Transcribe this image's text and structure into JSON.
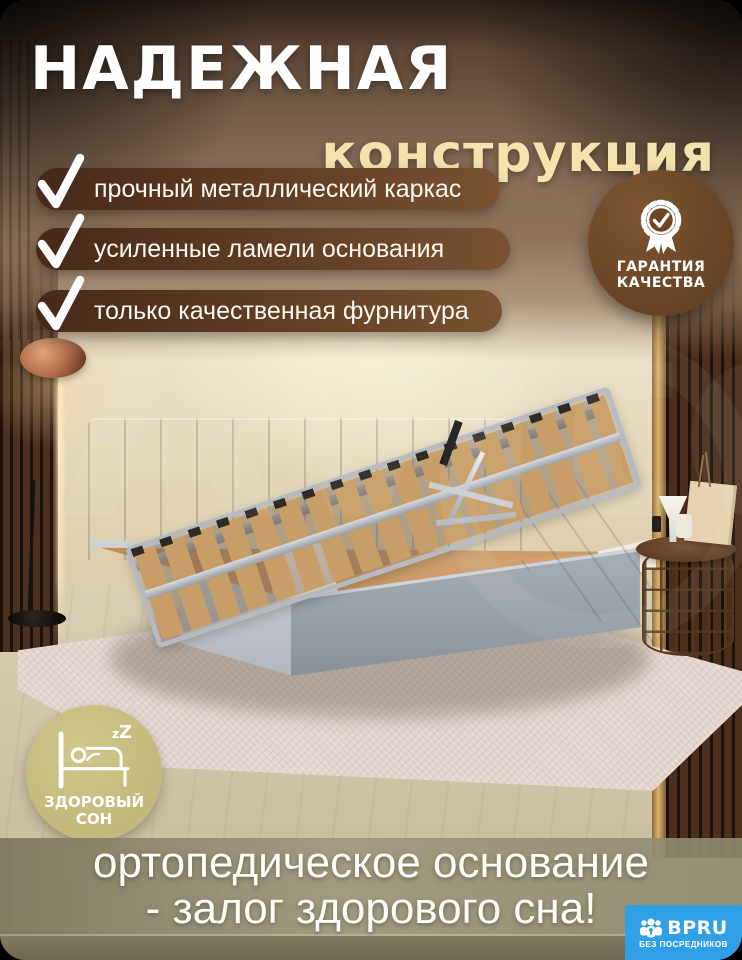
{
  "header": {
    "title_line1": "НАДЕЖНАЯ",
    "title_line2": "конструкция"
  },
  "features": [
    "прочный металлический каркас",
    "усиленные ламели основания",
    "только качественная фурнитура"
  ],
  "quality_badge": {
    "line1": "ГАРАНТИЯ",
    "line2": "КАЧЕСТВА"
  },
  "sleep_badge": {
    "zz": "zZ",
    "line1": "ЗДОРОВЫЙ",
    "line2": "СОН"
  },
  "footer": {
    "line1": "ортопедическое основание",
    "line2": "- залог здорового сна!"
  },
  "brand": {
    "name": "BPRU",
    "tagline": "БЕЗ ПОСРЕДНИКОВ"
  },
  "watermark": "Avito",
  "colors": {
    "accent_cream": "#f2e4ad",
    "pill_brown_dark": "#46291a",
    "pill_brown_light": "#7a5231",
    "quality_badge_brown": "#6b4626",
    "sleep_badge_olive": "#c6bd85",
    "footer_band_olive": "#95917a",
    "brand_blue": "#2f9fe6",
    "bed_gray": "#a5abb3"
  }
}
